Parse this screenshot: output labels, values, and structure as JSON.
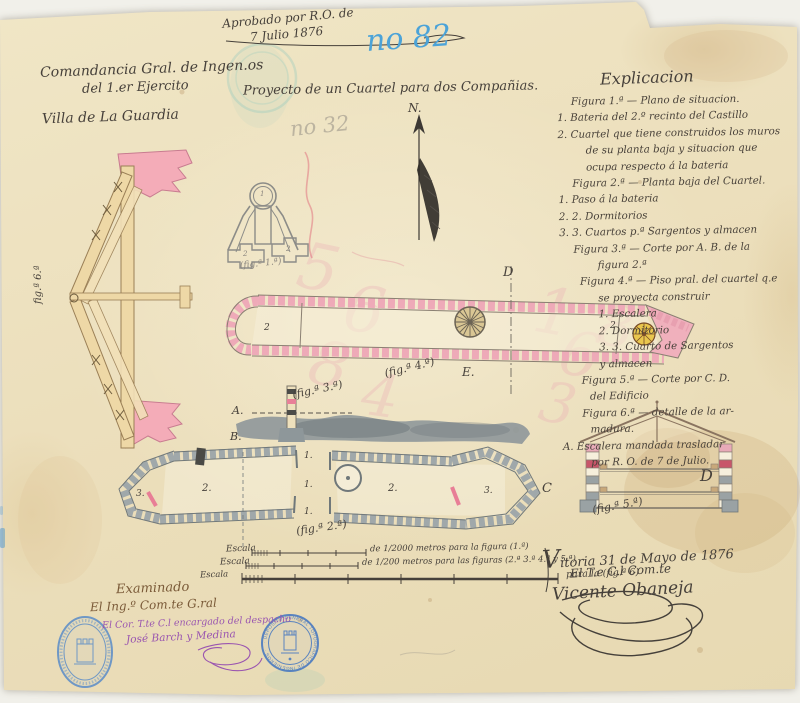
{
  "approval": {
    "line1": "Aprobado por R.O. de",
    "line2": "7 Julio 1876"
  },
  "doc_number": "no 82",
  "pencil_number": "no 32",
  "header": {
    "org_line1": "Comandancia Gral. de Ingen.os",
    "org_line2": "del 1.er Ejercito",
    "project_title": "Proyecto de un Cuartel para dos Compañias.",
    "place": "Villa de La Guardia"
  },
  "compass": {
    "north": "N."
  },
  "explanation": {
    "title": "Explicacion",
    "lines": [
      "Figura 1.ª — Plano de situacion.",
      "1. Bateria del 2.º recinto del Castillo",
      "2. Cuartel que tiene construidos los muros",
      "de su planta baja y situacion que",
      "ocupa respecto á la bateria",
      "Figura 2.ª — Planta baja del Cuartel.",
      "1. Paso á la bateria",
      "2. 2. Dormitorios",
      "3. 3. Cuartos p.ª Sargentos y almacen",
      "Figura 3.ª — Corte por A. B. de la",
      "figura 2.ª",
      "Figura 4.ª — Piso pral. del cuartel q.e",
      "se proyecta construir",
      "1. Escalera",
      "2. Dormitorio",
      "3. 3. Cuarto de Sargentos",
      "y almacen",
      "Figura 5.ª — Corte por C. D.",
      "del Edificio",
      "Figura 6.ª — detalle de la ar-",
      "madura.",
      "A. Escalera mandada trasladar",
      "por R. O. de 7 de Julio."
    ]
  },
  "figure_labels": {
    "fig1": "(fig.ª 1.ª)",
    "fig2": "(fig.ª 2.ª)",
    "fig3": "(fig.ª 3.ª)",
    "fig4": "(fig.ª 4.ª)",
    "fig5": "(fig.ª 5.ª)",
    "fig6": "fig.ª 6.ª"
  },
  "marks": {
    "a": "A.",
    "b": "B.",
    "c": "C",
    "d": "D",
    "e": "E.",
    "d2": "D",
    "n1": "1",
    "n2": "2",
    "n3": "3",
    "r1": "1.",
    "r2": "2.",
    "r3": "3."
  },
  "scales": {
    "s1_label": "Escala",
    "s1_text": "de 1/2000 metros para la figura (1.ª)",
    "s2_label": "Escala",
    "s2_text": "de 1/200 metros para las figuras (2.ª 3.ª 4.ª y 5.ª)",
    "s3_label": "Escala",
    "s3_text": "para la (fig.ª 6)"
  },
  "date_signature": {
    "place_date": "Vitoria 31 de Mayo de 1876",
    "rank": "El T.e C.l Com.te",
    "name": "Vicente Obaneja"
  },
  "examination": {
    "line1": "Examinado",
    "line2": "El Ing.º Com.te G.ral",
    "line3": "El Cor. T.te C.l encargado del despacho",
    "line4": "José Barch y Medina"
  },
  "stamps": {
    "round_text": "· DEPOSITO GENERAL TOPOGRAFICO DE INGENIEROS ·"
  },
  "bleedthrough_digits": [
    "5",
    "6",
    "8",
    "4",
    "1",
    "6",
    "8",
    "3"
  ],
  "colors": {
    "ink": "#46403a",
    "pink_wall": "#eeaab8",
    "gray_wall": "#a0a8aa",
    "wood": "#eed8a6",
    "stamp_blue": "#4a7ac0",
    "note_blue": "#54a8d8",
    "purple": "#9a55b0"
  }
}
